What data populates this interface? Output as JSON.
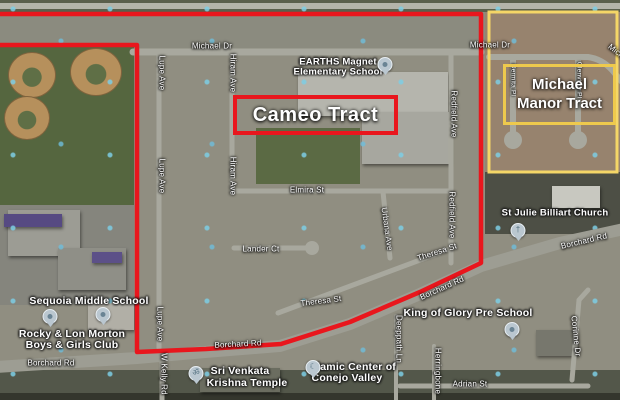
{
  "canvas": {
    "width": 620,
    "height": 400,
    "type": "satellite-map-annotation"
  },
  "colors": {
    "tract_outline_red": "#e9161d",
    "tract_outline_yellow": "#f4d667",
    "inner_box_yellow": "#eec94d",
    "street_label": "#ffffff",
    "road_gray": "#a8a89e"
  },
  "tracts": {
    "cameo": {
      "label": "Cameo Tract"
    },
    "michael_manor": {
      "line1": "Michael",
      "line2": "Manor Tract"
    }
  },
  "streets": {
    "michael_dr": "Michael Dr",
    "lupe_ave": "Lupe Ave",
    "hiram_ave": "Hiram Ave",
    "redfield_ave": "Redfield Ave",
    "urbana_ave": "Urbana Ave",
    "elmira_st": "Elmira St",
    "lander_ct": "Lander Ct",
    "theresa_st": "Theresa St",
    "borchard_rd": "Borchard Rd",
    "w_kelly_rd": "W Kelly Rd",
    "adrian_st": "Adrian St",
    "corinne_dr": "Corinne Dr",
    "deeppath_ln": "Deeppath Ln",
    "herringbone": "Herringbone",
    "dermita_pl": "Dermita Pl",
    "glenview_pl": "Glenview Pl"
  },
  "places": {
    "earths": {
      "line1": "EARTHS Magnet",
      "line2": "Elementary School"
    },
    "sequoia": {
      "name": "Sequoia Middle School"
    },
    "boys_girls_club": {
      "line1": "Rocky & Lon Morton",
      "line2": "Boys & Girls Club"
    },
    "st_julie": {
      "name": "St Julie Billiart Church"
    },
    "king_of_glory": {
      "name": "King of Glory Pre School"
    },
    "islamic_center": {
      "line1": "Islamic Center of",
      "line2": "Conejo Valley"
    },
    "krishna_temple": {
      "line1": "Sri Venkata",
      "line2": "Krishna Temple"
    }
  },
  "icons": {
    "church_pin": "†",
    "mosque_pin": "☾",
    "temple_pin": "ॐ"
  }
}
